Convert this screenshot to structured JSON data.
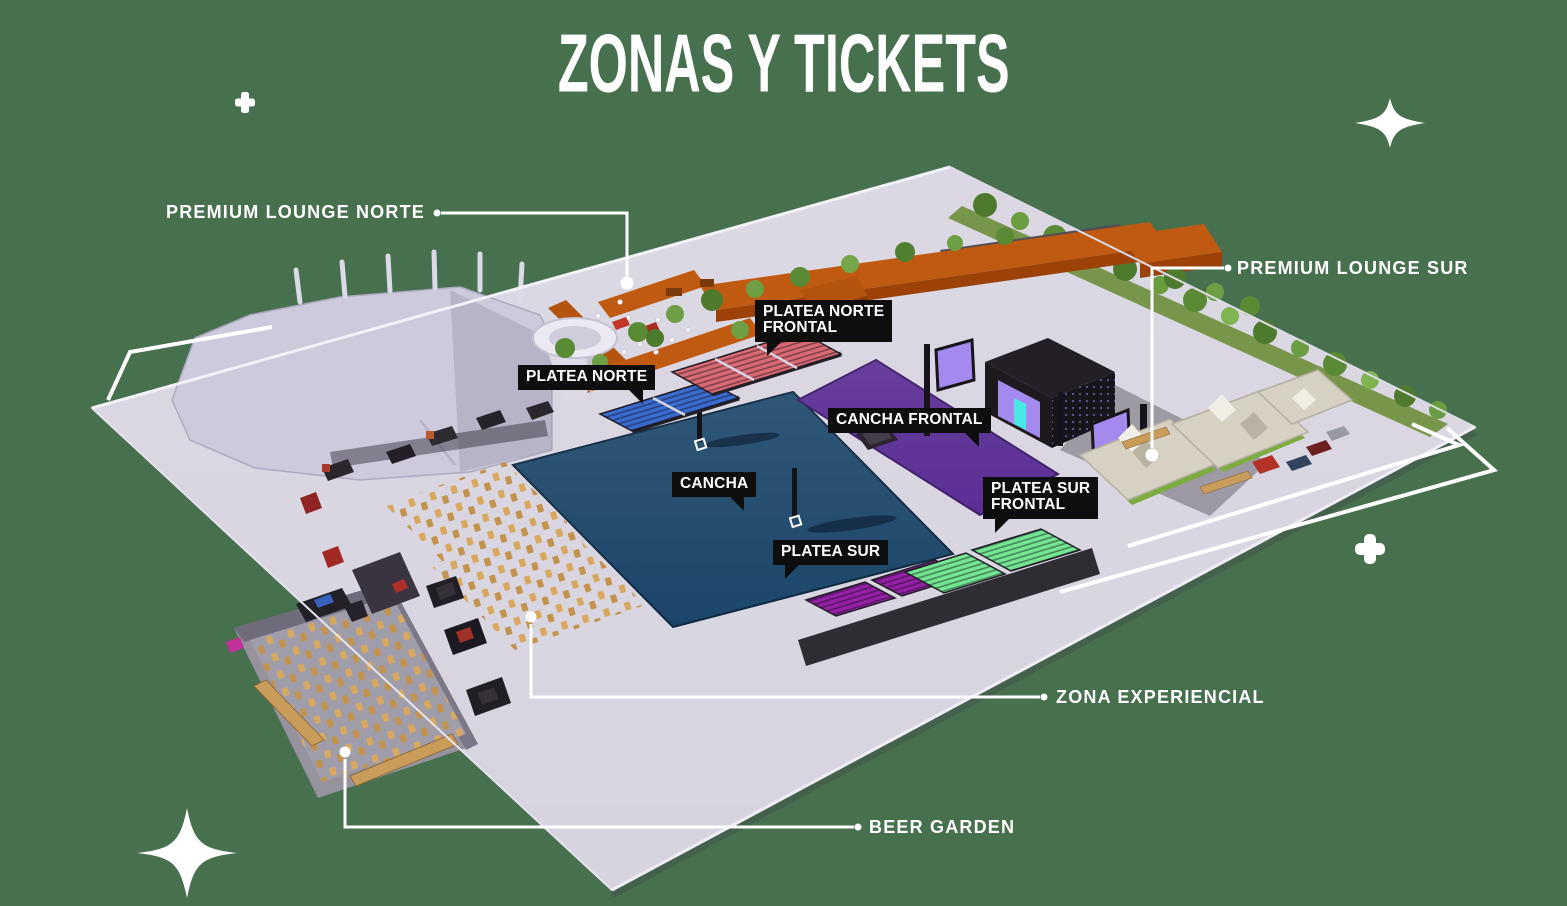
{
  "title": "ZONAS Y TICKETS",
  "bubbles": {
    "platea_norte_frontal": {
      "line1": "PLATEA NORTE",
      "line2": "FRONTAL"
    },
    "platea_norte": {
      "line1": "PLATEA NORTE"
    },
    "cancha_frontal": {
      "line1": "CANCHA FRONTAL"
    },
    "cancha": {
      "line1": "CANCHA"
    },
    "platea_sur": {
      "line1": "PLATEA SUR"
    },
    "platea_sur_frontal": {
      "line1": "PLATEA SUR",
      "line2": "FRONTAL"
    }
  },
  "callouts": {
    "premium_lounge_norte": "PREMIUM LOUNGE NORTE",
    "premium_lounge_sur": "PREMIUM LOUNGE SUR",
    "zona_experiencial": "ZONA EXPERIENCIAL",
    "beer_garden": "BEER GARDEN"
  },
  "colors": {
    "background": "#47704F",
    "plaza": "#D7D4E0",
    "cancha": "#1B4669",
    "cancha_frontal": "#5B2E95",
    "platea_norte": "#3A6BD0",
    "platea_norte_frontal": "#D96A74",
    "platea_sur": "#951FA5",
    "platea_sur_frontal": "#74E591",
    "premium_lounge_norte_building": "#C05A10",
    "arena": "#CCCADB",
    "stage": "#241F26",
    "stage_screen": "#A489EE",
    "stage_screen_accent": "#49E8E4",
    "grass": "#7CAB3E",
    "tree": "#5A8A34",
    "tent": "#D6D1C3",
    "wood_table": "#D9A85F",
    "label_bg": "#0E0E0E",
    "label_text": "#FFFFFF",
    "line": "#FFFFFF"
  }
}
